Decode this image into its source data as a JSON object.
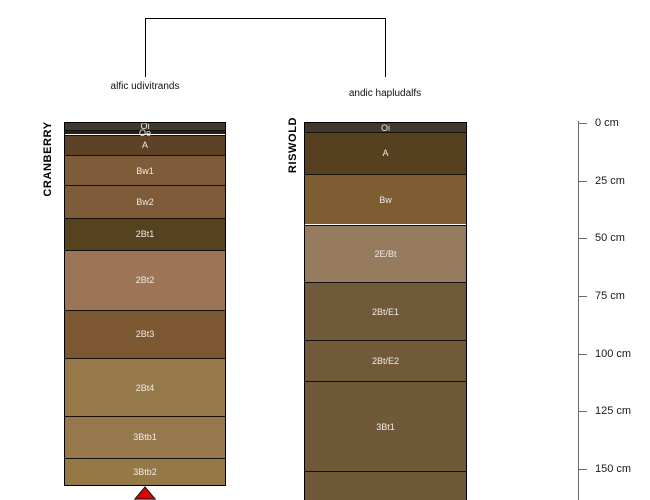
{
  "figure": {
    "background": "#ffffff",
    "bracket_color": "#000000",
    "depth_axis": {
      "unit": "cm",
      "ticks_cm": [
        0,
        25,
        50,
        75,
        100,
        125,
        150
      ],
      "tick_labels": [
        "0 cm",
        "25 cm",
        "50 cm",
        "75 cm",
        "100 cm",
        "125 cm",
        "150 cm"
      ],
      "line_color": "#6b6b6b",
      "text_color": "#1a1a1a"
    }
  },
  "chart_data": {
    "type": "soil-profile-diagram",
    "description": "Two soil profile sketches joined by a dendrogram bracket; horizon depths in cm read from the right-hand depth axis",
    "depth_range_cm": [
      0,
      163
    ],
    "legend_position": "none",
    "profiles": [
      {
        "id": "CRANBERRY",
        "taxon": "alfic udivitrands",
        "truncated": true,
        "arrow_color": "#e60000",
        "horizons": [
          {
            "name": "Oi",
            "top_cm": 0,
            "bottom_cm": 3,
            "color": "#3f3833"
          },
          {
            "name": "Oe",
            "top_cm": 3,
            "bottom_cm": 5,
            "color": "#262019"
          },
          {
            "name": "A",
            "top_cm": 5,
            "bottom_cm": 14,
            "color": "#5d4226"
          },
          {
            "name": "Bw1",
            "top_cm": 14,
            "bottom_cm": 27,
            "color": "#7e5b39"
          },
          {
            "name": "Bw2",
            "top_cm": 27,
            "bottom_cm": 41,
            "color": "#7e5b39"
          },
          {
            "name": "2Bt1",
            "top_cm": 41,
            "bottom_cm": 55,
            "color": "#57421f"
          },
          {
            "name": "2Bt2",
            "top_cm": 55,
            "bottom_cm": 81,
            "color": "#9c7557"
          },
          {
            "name": "2Bt3",
            "top_cm": 81,
            "bottom_cm": 102,
            "color": "#7c5732"
          },
          {
            "name": "2Bt4",
            "top_cm": 102,
            "bottom_cm": 127,
            "color": "#977849"
          },
          {
            "name": "3Btb1",
            "top_cm": 127,
            "bottom_cm": 145,
            "color": "#97784c"
          },
          {
            "name": "3Btb2",
            "top_cm": 145,
            "bottom_cm": 157,
            "color": "#967746"
          }
        ]
      },
      {
        "id": "RISWOLD",
        "taxon": "andic hapludalfs",
        "truncated": false,
        "horizons": [
          {
            "name": "Oi",
            "top_cm": 0,
            "bottom_cm": 4,
            "color": "#40372d"
          },
          {
            "name": "A",
            "top_cm": 4,
            "bottom_cm": 22,
            "color": "#56401f"
          },
          {
            "name": "Bw",
            "top_cm": 22,
            "bottom_cm": 44,
            "color": "#7d5d31"
          },
          {
            "name": "2E/Bt",
            "top_cm": 44,
            "bottom_cm": 69,
            "color": "#967b5f"
          },
          {
            "name": "2Bt/E1",
            "top_cm": 69,
            "bottom_cm": 94,
            "color": "#705a3a"
          },
          {
            "name": "2Bt/E2",
            "top_cm": 94,
            "bottom_cm": 112,
            "color": "#705a3a"
          },
          {
            "name": "3Bt1",
            "top_cm": 112,
            "bottom_cm": 151,
            "color": "#6f5938"
          },
          {
            "name": "",
            "top_cm": 151,
            "bottom_cm": 164,
            "color": "#6f5938"
          }
        ]
      }
    ]
  }
}
